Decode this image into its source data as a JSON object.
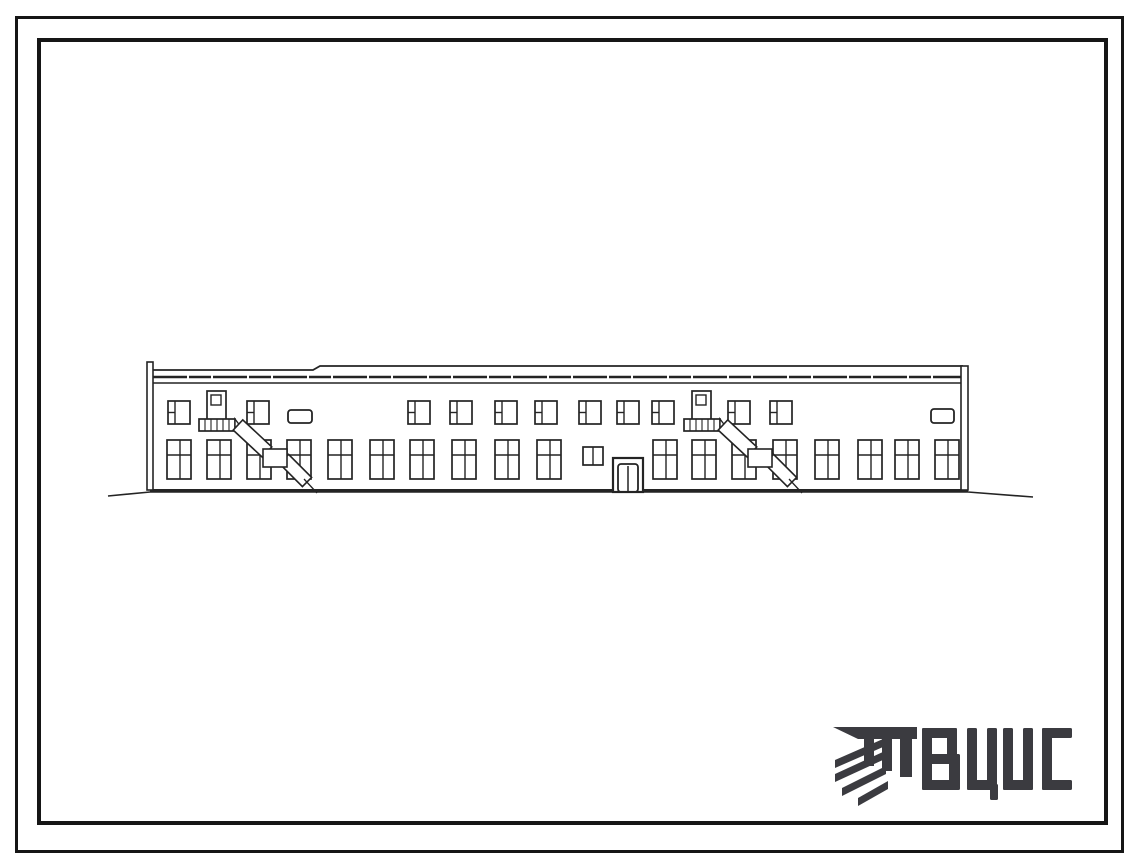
{
  "page": {
    "bg": "#ffffff",
    "ink": "#242424"
  },
  "frame": {
    "color": "#161616",
    "outer": {
      "x": 15,
      "y": 16,
      "w": 1109,
      "h": 837,
      "t": 3
    },
    "inner": {
      "x": 37,
      "y": 38,
      "w": 1071,
      "h": 787,
      "t": 4
    }
  },
  "logo": {
    "text": "ВЦИС",
    "color": "#3b3b40",
    "icon_name": "vcis-hatched-mark",
    "top": 728,
    "letter_height": 62,
    "letters": [
      {
        "char": "В",
        "x": 922,
        "rects": [
          [
            0,
            0,
            10,
            62
          ],
          [
            0,
            0,
            35,
            10
          ],
          [
            0,
            26,
            35,
            10
          ],
          [
            0,
            52,
            35,
            10
          ],
          [
            25,
            0,
            10,
            32
          ],
          [
            27,
            26,
            11,
            36
          ]
        ]
      },
      {
        "char": "Ц",
        "x": 967,
        "rects": [
          [
            0,
            0,
            10,
            62
          ],
          [
            20,
            0,
            10,
            62
          ],
          [
            0,
            52,
            30,
            10
          ],
          [
            23,
            56,
            8,
            16
          ]
        ]
      },
      {
        "char": "И",
        "x": 1003,
        "rects": [
          [
            0,
            0,
            10,
            62
          ],
          [
            20,
            0,
            10,
            62
          ],
          [
            0,
            52,
            30,
            10
          ]
        ]
      },
      {
        "char": "С",
        "x": 1042,
        "rects": [
          [
            0,
            0,
            10,
            62
          ],
          [
            0,
            0,
            30,
            10
          ],
          [
            0,
            52,
            30,
            10
          ]
        ]
      }
    ],
    "icon": {
      "bar": [
        [
          833,
          727
        ],
        [
          917,
          727
        ],
        [
          917,
          739
        ],
        [
          858,
          739
        ]
      ],
      "legs": [
        [
          864,
          739,
          10,
          27
        ],
        [
          882,
          739,
          10,
          32
        ],
        [
          900,
          739,
          12,
          38
        ]
      ],
      "stripes": [
        [
          835,
          760,
          883,
          739,
          8
        ],
        [
          835,
          774,
          885,
          751,
          8
        ],
        [
          842,
          788,
          886,
          766,
          8
        ],
        [
          858,
          798,
          888,
          781,
          8
        ]
      ]
    }
  },
  "elevation": {
    "name": "industrial-building-front-elevation",
    "wall": {
      "left": 152,
      "right": 963,
      "top": 366,
      "bottom": 490
    },
    "parapet": {
      "top_left_y": 370,
      "top_right_y": 366,
      "step_x": 313,
      "line2_y": 377,
      "line3_y": 383
    },
    "posts": [
      {
        "x": 147,
        "w": 6,
        "top": 362
      },
      {
        "x": 961,
        "w": 7,
        "top": 366
      }
    ],
    "ground": {
      "main": [
        150,
        490.5,
        968,
        490.5
      ],
      "profile": [
        [
          108,
          496
        ],
        [
          150,
          492
        ],
        [
          968,
          492
        ],
        [
          1033,
          497
        ]
      ]
    },
    "upper_windows": {
      "y": 401,
      "w": 22,
      "h": 23,
      "xs": [
        168,
        247,
        408,
        450,
        495,
        535,
        579,
        617,
        652,
        728,
        770
      ]
    },
    "lower_windows": {
      "y": 440,
      "w": 24,
      "h": 39,
      "xs": [
        167,
        207,
        247,
        287,
        328,
        370,
        410,
        452,
        495,
        537,
        653,
        692,
        732,
        773,
        815,
        858,
        895,
        935
      ]
    },
    "mid_window": {
      "x": 583,
      "y": 447,
      "w": 20,
      "h": 18
    },
    "door": {
      "x": 613,
      "y": 458,
      "w": 30,
      "h": 34
    },
    "vents": [
      {
        "x": 288,
        "y": 410,
        "w": 24,
        "h": 13
      },
      {
        "x": 931,
        "y": 409,
        "w": 23,
        "h": 14
      }
    ],
    "hoists": [
      {
        "chimney": {
          "x": 207,
          "y": 391,
          "w": 19,
          "h": 29
        },
        "head": {
          "x": 199,
          "y": 419,
          "w": 36,
          "h": 12
        },
        "seg1": [
          238,
          425,
          267,
          452
        ],
        "joint": {
          "x": 263,
          "y": 449,
          "w": 24,
          "h": 18
        },
        "seg2": [
          284,
          459,
          307,
          482
        ],
        "tail": [
          304,
          479,
          317,
          493
        ]
      },
      {
        "chimney": {
          "x": 692,
          "y": 391,
          "w": 19,
          "h": 29
        },
        "head": {
          "x": 684,
          "y": 419,
          "w": 36,
          "h": 12
        },
        "seg1": [
          723,
          425,
          752,
          452
        ],
        "joint": {
          "x": 748,
          "y": 449,
          "w": 24,
          "h": 18
        },
        "seg2": [
          769,
          459,
          792,
          482
        ],
        "tail": [
          789,
          479,
          802,
          493
        ]
      }
    ]
  }
}
